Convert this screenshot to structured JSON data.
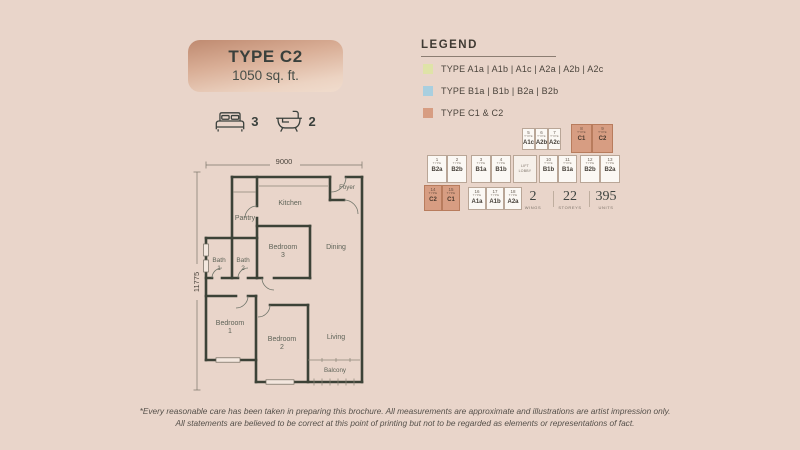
{
  "unit_card": {
    "title": "TYPE C2",
    "area": "1050 sq. ft.",
    "bedrooms": "3",
    "bathrooms": "2"
  },
  "legend": {
    "title": "LEGEND",
    "items": [
      {
        "label": "TYPE A1a | A1b | A1c | A2a | A2b | A2c",
        "color": "#dfe3a8"
      },
      {
        "label": "TYPE B1a | B1b | B2a | B2b",
        "color": "#a9cfdf"
      },
      {
        "label": "TYPE C1 & C2",
        "color": "#d79d82"
      }
    ]
  },
  "floorplan": {
    "dim_width": "9000",
    "dim_height": "11775",
    "labels": {
      "foyer": "Foyer",
      "kitchen": "Kitchen",
      "pantry": "Pantry",
      "bedroom3_1": "Bedroom",
      "bedroom3_2": "3",
      "dining": "Dining",
      "bath1_1": "Bath",
      "bath1_2": "1",
      "bath2_1": "Bath",
      "bath2_2": "2",
      "bedroom1_1": "Bedroom",
      "bedroom1_2": "1",
      "bedroom2_1": "Bedroom",
      "bedroom2_2": "2",
      "living": "Living",
      "balcony": "Balcony"
    }
  },
  "siteplan": {
    "type_word": "TYPE",
    "lobby_line1": "LIFT",
    "lobby_line2": "LOBBY",
    "units": {
      "mid_left": [
        {
          "no": "1",
          "code": "B2a"
        },
        {
          "no": "2",
          "code": "B2b"
        },
        {
          "no": "3",
          "code": "B1a"
        },
        {
          "no": "4",
          "code": "B1b"
        }
      ],
      "top_white": [
        {
          "no": "5",
          "code": "A1c"
        },
        {
          "no": "6",
          "code": "A2b"
        },
        {
          "no": "7",
          "code": "A2c"
        }
      ],
      "top_salmon": [
        {
          "no": "8",
          "code": "C1"
        },
        {
          "no": "9",
          "code": "C2"
        }
      ],
      "mid_right": [
        {
          "no": "10",
          "code": "B1b"
        },
        {
          "no": "11",
          "code": "B1a"
        },
        {
          "no": "12",
          "code": "B2b"
        },
        {
          "no": "13",
          "code": "B2a"
        }
      ],
      "bottom_salmon": [
        {
          "no": "14",
          "code": "C2"
        },
        {
          "no": "15",
          "code": "C1"
        }
      ],
      "bottom_white": [
        {
          "no": "16",
          "code": "A1a"
        },
        {
          "no": "17",
          "code": "A1b"
        },
        {
          "no": "18",
          "code": "A2a"
        }
      ]
    },
    "stats": [
      {
        "value": "2",
        "label": "WINGS"
      },
      {
        "value": "22",
        "label": "STOREYS"
      },
      {
        "value": "395",
        "label": "UNITS"
      }
    ]
  },
  "footer": {
    "line1": "*Every reasonable care has been taken in preparing this brochure. All measurements are approximate and illustrations are artist impression only.",
    "line2": "All statements are believed to be correct at this point of printing but not to be regarded as elements or representations of fact."
  },
  "colors": {
    "background": "#e9d5ca",
    "card_gradient_top": "#bf8a70",
    "card_gradient_bottom": "#f0dccd",
    "wall": "#3c4237",
    "type_a_swatch": "#dfe3a8",
    "type_b_swatch": "#a9cfdf",
    "type_c_swatch": "#d79d82"
  }
}
